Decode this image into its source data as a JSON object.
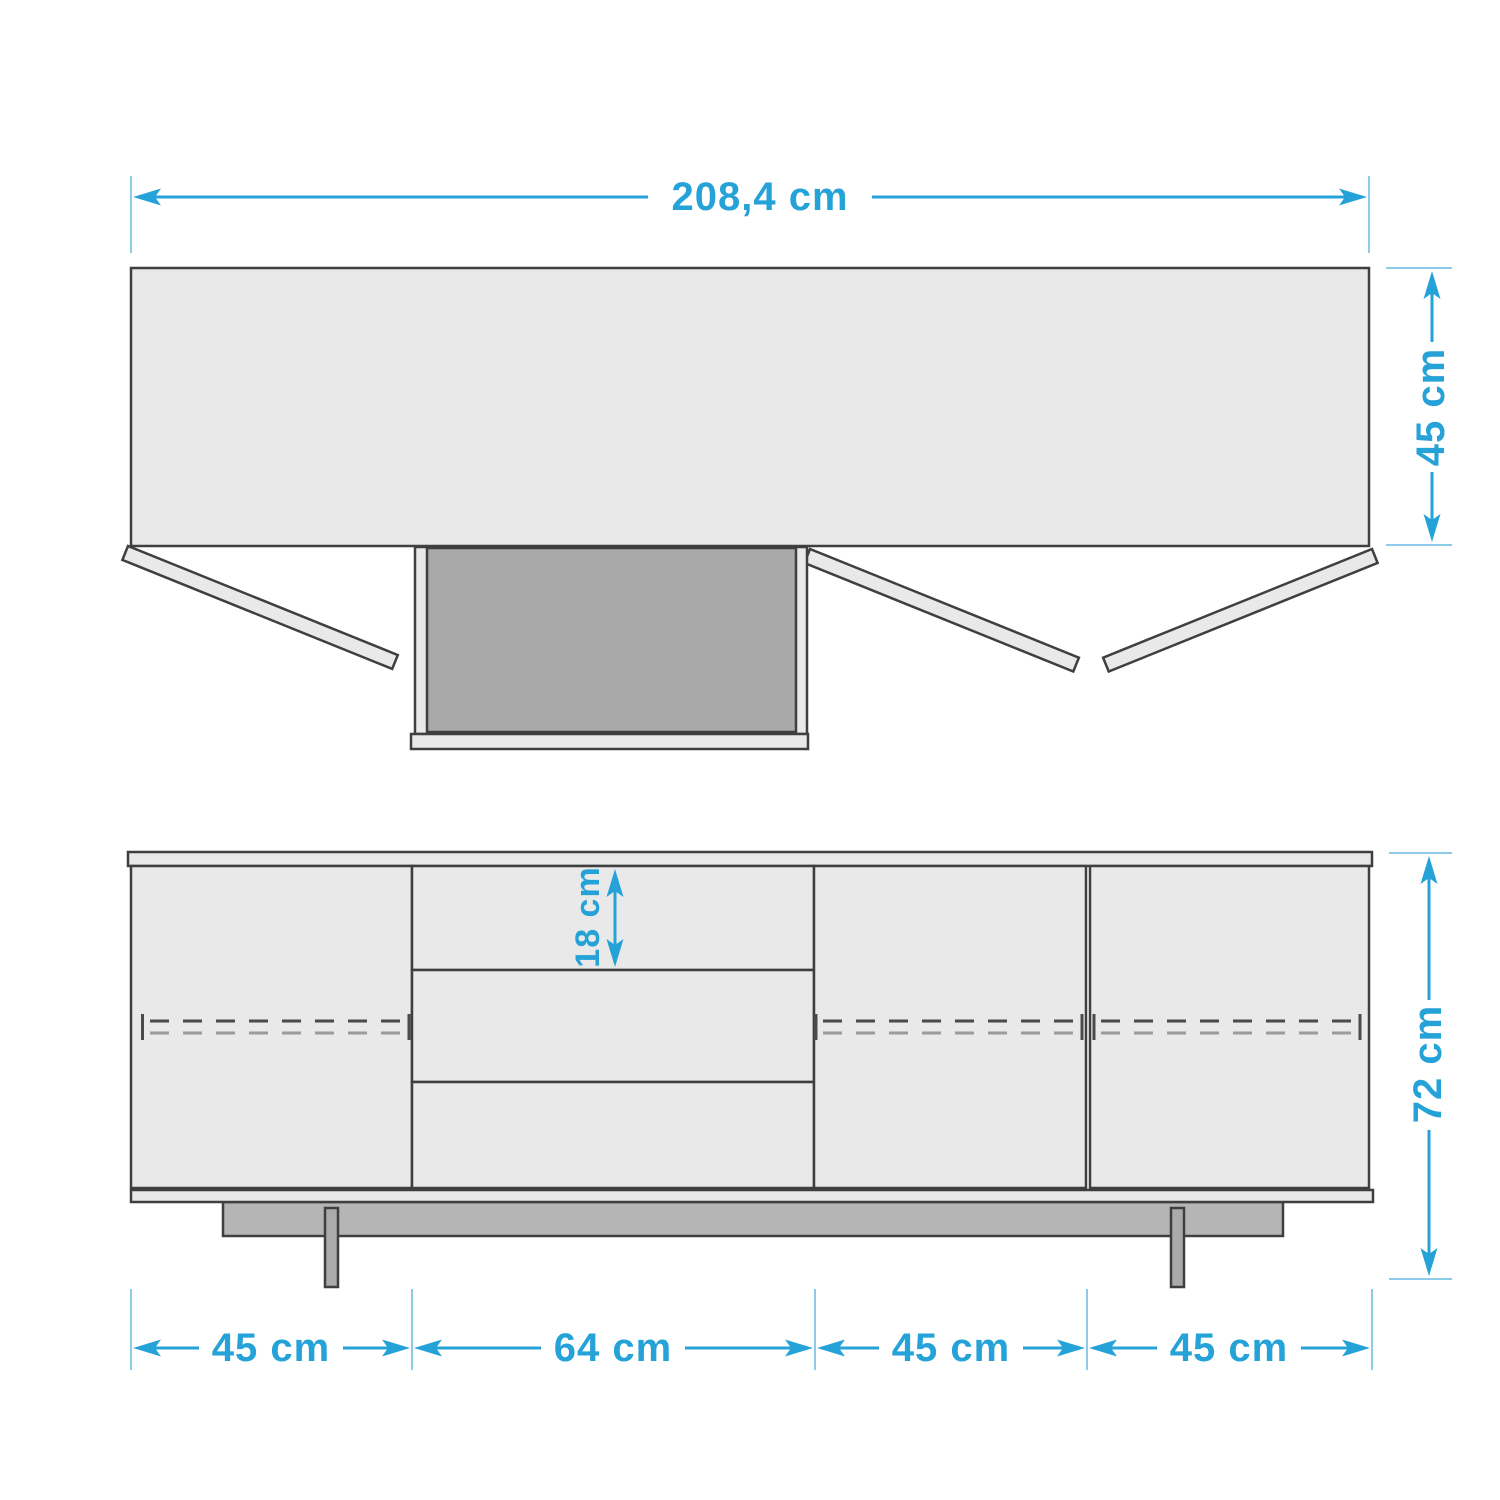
{
  "diagram": {
    "type": "furniture-dimension-drawing",
    "subject": "sideboard with 3 doors and 3 drawers, shown in top view and front view",
    "views": {
      "top": {
        "width_label": "208,4 cm",
        "depth_label": "45 cm"
      },
      "front": {
        "height_label": "72 cm",
        "drawer_height_label": "18 cm",
        "section_labels": [
          "45 cm",
          "64 cm",
          "45 cm",
          "45 cm"
        ]
      }
    },
    "dimensions_cm": {
      "total_width": 208.4,
      "depth": 45,
      "total_height": 72,
      "top_drawer_height": 18,
      "section_widths": [
        45,
        64,
        45,
        45
      ]
    },
    "colors": {
      "accent_blue": "#25A2D8",
      "extension_blue": "#8ECBE8",
      "outline": "#3F3F3F",
      "panel_fill": "#E9E9E9",
      "drawer_interior": "#A9A9A9",
      "plinth_fill": "#B5B5B5",
      "leg_fill": "#ABABAB",
      "hidden_line_dark": "#4B4B4B",
      "hidden_line_light": "#9B9B9B",
      "background": "#FFFFFF"
    }
  }
}
